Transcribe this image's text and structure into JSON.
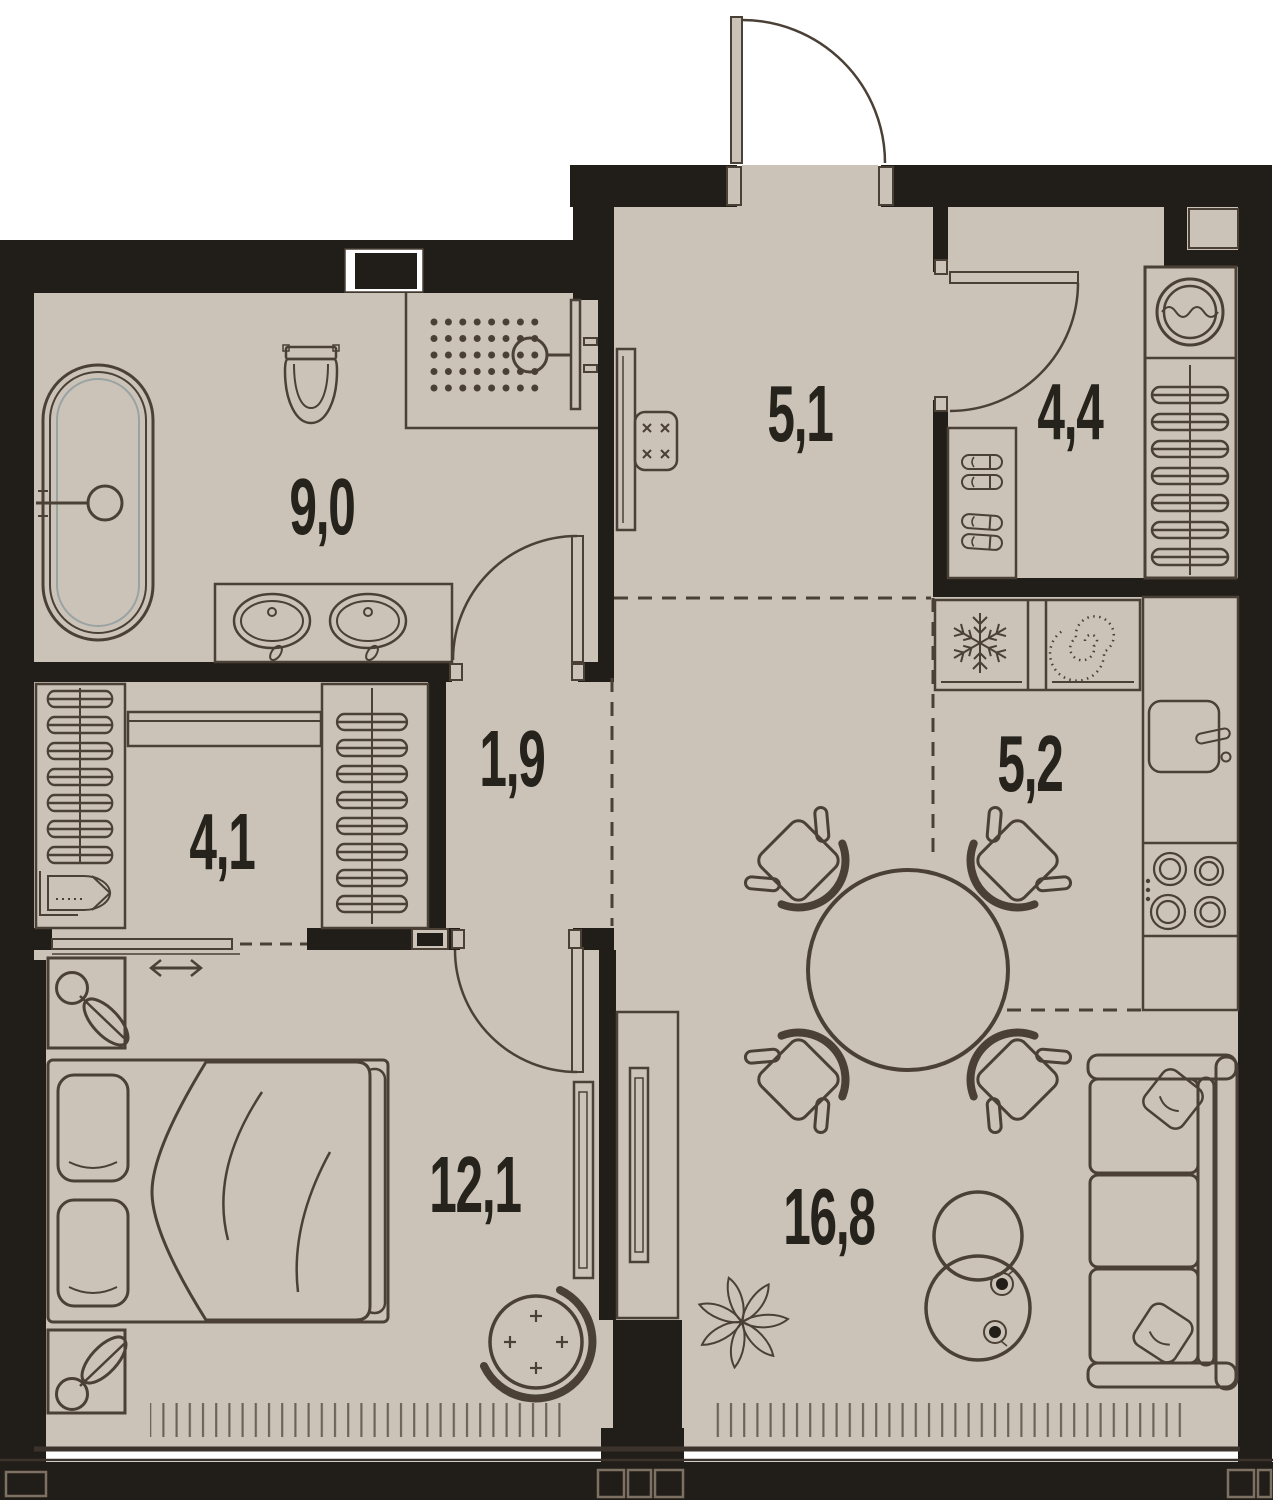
{
  "plan": {
    "title": "one-bedroom apartment floor plan",
    "colors": {
      "floor": "#cbc3b8",
      "wall": "#211d18",
      "line": "#4a4036",
      "line_light": "#8a7d6e",
      "glass_line": "#9aa3a3",
      "label": "#26221c",
      "background": "#ffffff"
    },
    "rooms": [
      {
        "id": "bathroom",
        "area": "9,0"
      },
      {
        "id": "hallway",
        "area": "5,1"
      },
      {
        "id": "wardrobe",
        "area": "4,4"
      },
      {
        "id": "kitchen",
        "area": "5,2"
      },
      {
        "id": "corridor",
        "area": "1,9"
      },
      {
        "id": "dressing-room",
        "area": "4,1"
      },
      {
        "id": "bedroom",
        "area": "12,1"
      },
      {
        "id": "living-room",
        "area": "16,8"
      }
    ],
    "symbols": [
      "bathtub",
      "toilet",
      "shower",
      "double-sink-vanity",
      "washing-machine",
      "hanger-shelf-column",
      "shoe-rack",
      "fridge-snowflake-icon",
      "hood-spiral-icon",
      "kitchen-sink",
      "cooktop",
      "dining-table",
      "dining-chair",
      "double-bed",
      "nightstand",
      "potted-plant",
      "tv-panel",
      "tv-cabinet",
      "sofa",
      "coffee-table",
      "papasan-chair",
      "door-swing-arc",
      "sliding-door-arrow-icon",
      "window-hatch"
    ]
  }
}
